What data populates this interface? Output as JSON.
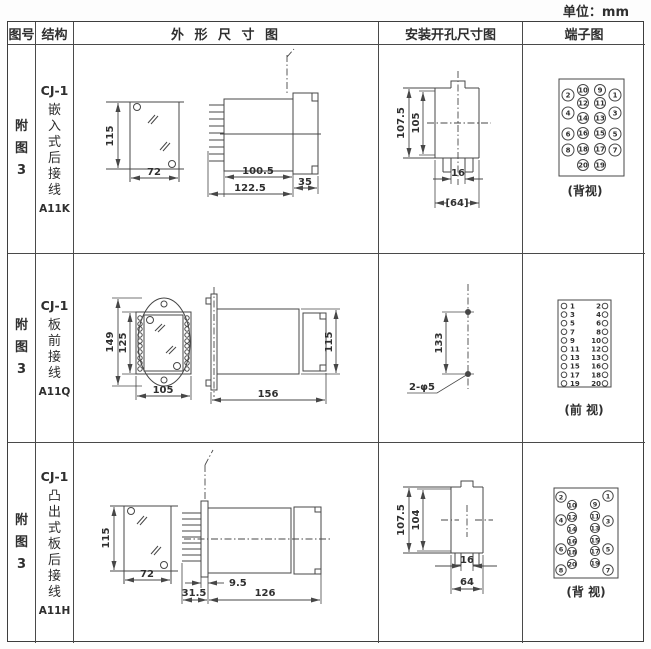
{
  "unit_label": "单位：mm",
  "table_header": {
    "figure": "图号",
    "structure": "结构",
    "outline": "外 形 尺 寸 图",
    "mounting": "安装开孔尺寸图",
    "terminal": "端子图"
  },
  "rows": [
    {
      "figure": "附图3",
      "structure": {
        "model": "CJ-1",
        "desc": "嵌入式后接线",
        "code": "A11K"
      },
      "outline_dims": {
        "height": "115",
        "width": "72",
        "body_len": "100.5",
        "total_len": "122.5",
        "flange": "35"
      },
      "mounting_dims": {
        "h_outer": "107.5",
        "h_inner": "105",
        "slot": "16",
        "width": "[64]"
      },
      "terminal": {
        "view_label": "(背视)",
        "inner_left": [
          "10",
          "12",
          "14",
          "16",
          "18",
          "20"
        ],
        "inner_right": [
          "9",
          "11",
          "13",
          "15",
          "17",
          "19"
        ],
        "outer_left": [
          "2",
          "4",
          "6",
          "8"
        ],
        "outer_right": [
          "1",
          "3",
          "5",
          "7"
        ]
      }
    },
    {
      "figure": "附图3",
      "structure": {
        "model": "CJ-1",
        "desc": "板前接线",
        "code": "A11Q"
      },
      "outline_dims": {
        "oval_height": "149",
        "panel_height": "125",
        "width": "105",
        "length": "156",
        "height": "115"
      },
      "mounting_dims": {
        "spacing": "133",
        "holes": "2-φ5"
      },
      "terminal": {
        "view_label": "(前 视)",
        "left": [
          "1",
          "3",
          "5",
          "7",
          "9",
          "11",
          "13",
          "15",
          "17",
          "19"
        ],
        "right": [
          "2",
          "4",
          "6",
          "8",
          "10",
          "12",
          "13",
          "16",
          "18",
          "20"
        ]
      }
    },
    {
      "figure": "附图3",
      "structure": {
        "model": "CJ-1",
        "desc": "凸出式板后接线",
        "code": "A11H"
      },
      "outline_dims": {
        "height": "115",
        "width": "72",
        "depth": "31.5",
        "plate": "9.5",
        "length": "126"
      },
      "mounting_dims": {
        "h_outer": "107.5",
        "h_inner": "104",
        "slot": "16",
        "width": "64"
      },
      "terminal": {
        "view_label": "(背 视)",
        "inner_left": [
          "10",
          "12",
          "14",
          "16",
          "18",
          "20"
        ],
        "inner_right": [
          "9",
          "11",
          "13",
          "15",
          "17",
          "19"
        ],
        "outer_left": [
          "2",
          "4",
          "6",
          "8"
        ],
        "outer_right": [
          "1",
          "3",
          "5",
          "7"
        ]
      }
    }
  ],
  "colors": {
    "line": "#474747",
    "text": "#2f2f2f",
    "background": "#ffffff"
  }
}
